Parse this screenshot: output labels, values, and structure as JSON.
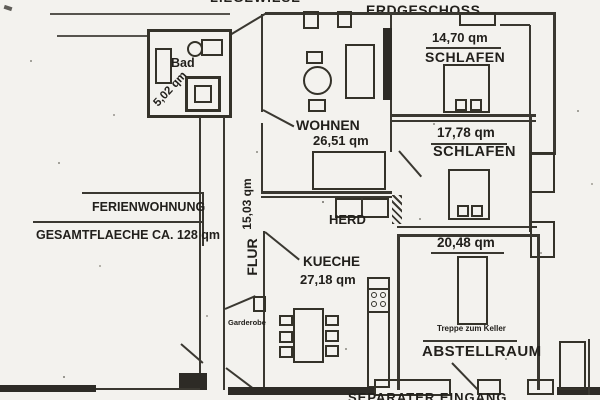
{
  "plan": {
    "site_label": "LIEGEWIESE",
    "floor_label": "ERDGESCHOSS",
    "apartment_name": "FERIENWOHNUNG",
    "total_area": "GESAMTFLAECHE CA. 128 qm",
    "rooms": {
      "bad": {
        "name": "Bad",
        "area": "5,02 qm"
      },
      "wohnen": {
        "name": "WOHNEN",
        "area": "26,51 qm"
      },
      "schlafen_klein": {
        "name": "SCHLAFEN",
        "area": "14,70 qm"
      },
      "schlafen_gross": {
        "name": "SCHLAFEN",
        "area": "17,78 qm"
      },
      "flur": {
        "name": "FLUR",
        "area": "15,03 qm"
      },
      "kueche": {
        "name": "KUECHE",
        "area": "27,18 qm"
      },
      "abstellraum": {
        "name": "ABSTELLRAUM",
        "area": "20,48 qm"
      }
    },
    "annotations": {
      "herd": "HERD",
      "garderobe": "Garderobe",
      "treppe_zum_keller": "Treppe zum Keller",
      "eingang": "SEPARATER EINGANG"
    },
    "colors": {
      "paper": "#f3f2ee",
      "ink": "#22201c",
      "wall": "#3a3831"
    }
  }
}
